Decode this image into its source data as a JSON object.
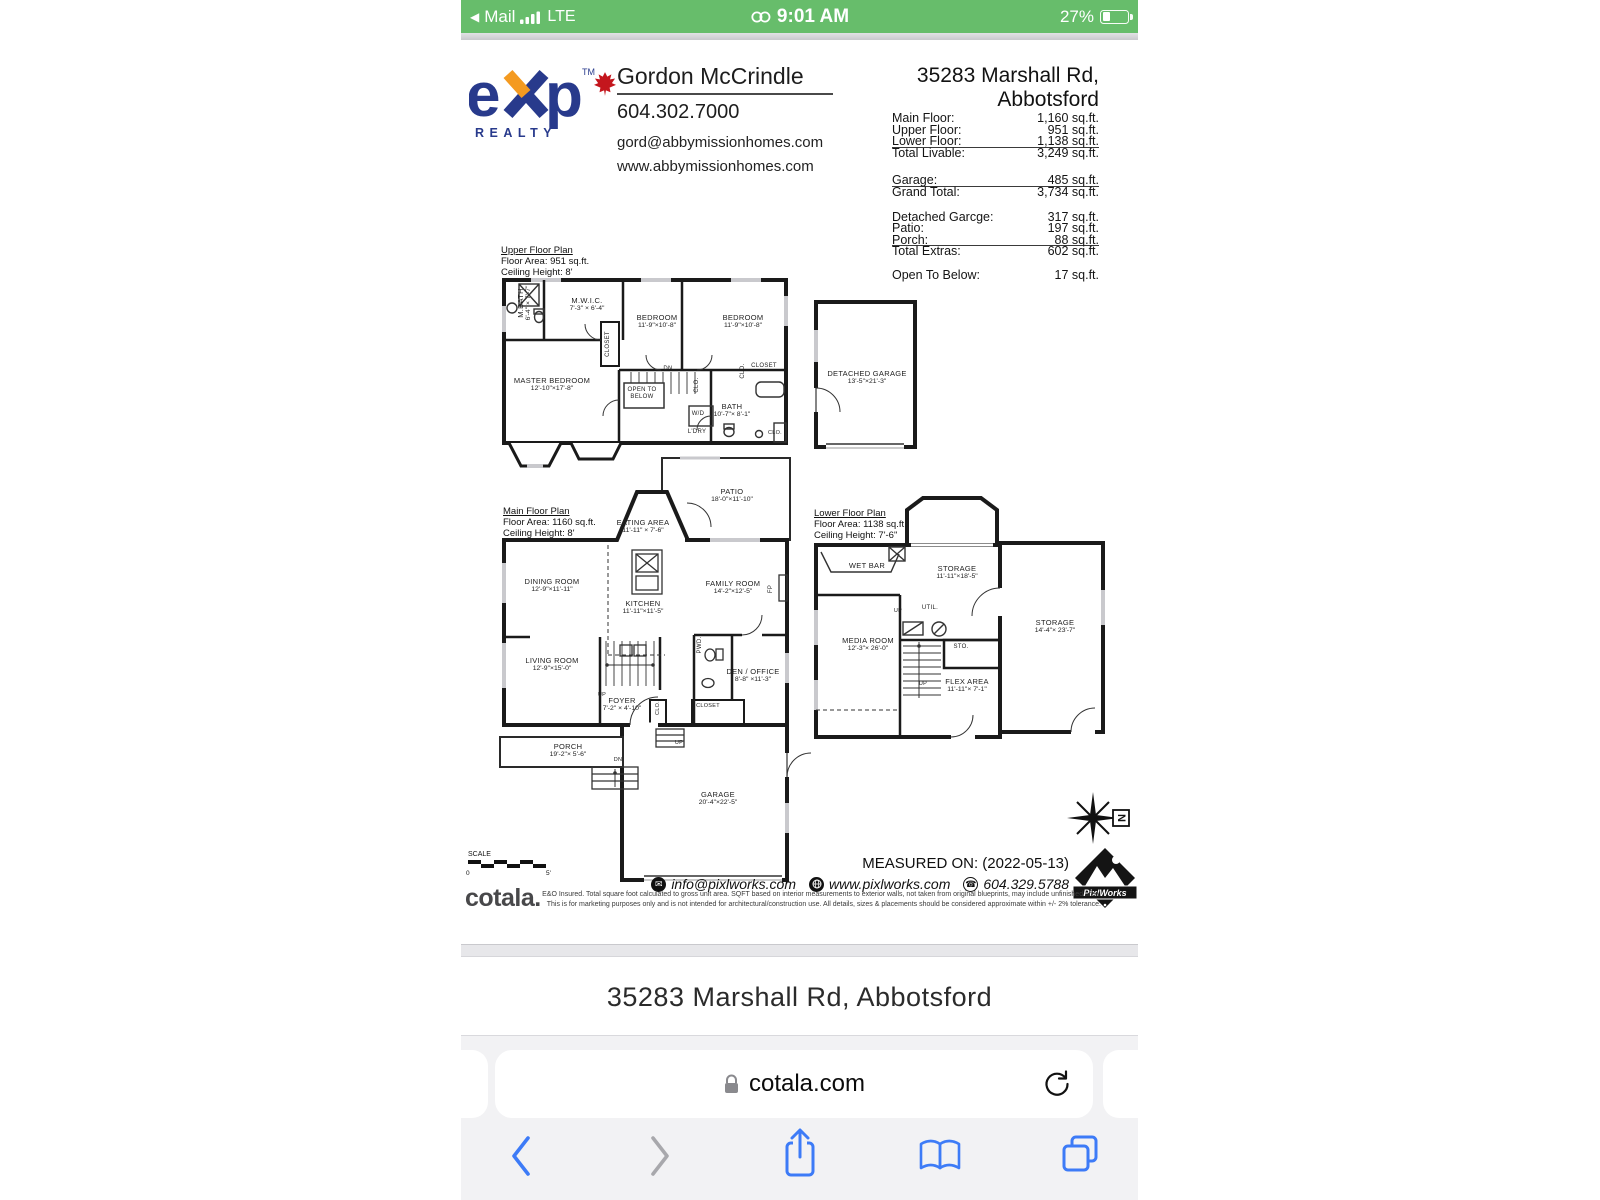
{
  "status_bar": {
    "back_app": "Mail",
    "network": "LTE",
    "time": "9:01 AM",
    "battery": "27%"
  },
  "sheet": {
    "brand": {
      "e": "e",
      "p": "p",
      "tm": "TM",
      "realty": "REALTY",
      "colors": {
        "navy": "#283a8c",
        "orange": "#f49a20",
        "leaf_red": "#c4161d"
      }
    },
    "agent": {
      "name": "Gordon McCrindle",
      "phone": "604.302.7000",
      "email": "gord@abbymissionhomes.com",
      "website": "www.abbymissionhomes.com"
    },
    "address": {
      "line1": "35283 Marshall Rd,",
      "line2": "Abbotsford"
    },
    "area_table": {
      "groups": [
        {
          "rows": [
            {
              "label": "Main Floor:",
              "value": "1,160 sq.ft."
            },
            {
              "label": "Upper Floor:",
              "value": "951 sq.ft."
            },
            {
              "label": "Lower Floor:",
              "value": "1,138 sq.ft."
            },
            {
              "label": "Total Livable:",
              "value": "3,249 sq.ft."
            }
          ]
        },
        {
          "rows": [
            {
              "label": "Garage:",
              "value": "485 sq.ft."
            },
            {
              "label": "Grand Total:",
              "value": "3,734 sq.ft."
            }
          ]
        },
        {
          "rows": [
            {
              "label": "Detached Garcge:",
              "value": "317 sq.ft."
            },
            {
              "label": "Patio:",
              "value": "197 sq.ft."
            },
            {
              "label": "Porch:",
              "value": "88 sq.ft."
            },
            {
              "label": "Total Extras:",
              "value": "602 sq.ft."
            }
          ]
        },
        {
          "rows": [
            {
              "label": "Open To Below:",
              "value": "17 sq.ft."
            }
          ]
        }
      ]
    },
    "plans": {
      "upper": {
        "title": "Upper Floor Plan",
        "area": "Floor Area: 951 sq.ft.",
        "ceiling": "Ceiling Height: 8'",
        "rooms": [
          {
            "name": "M.BATH",
            "dims": "6'-4\" × 7'-7\""
          },
          {
            "name": "M.W.I.C.",
            "dims": "7'-3\" × 6'-4\""
          },
          {
            "name": "BEDROOM",
            "dims": "11'-9\"×10'-8\""
          },
          {
            "name": "BEDROOM",
            "dims": "11'-9\"×10'-8\""
          },
          {
            "name": "MASTER BEDROOM",
            "dims": "12'-10\"×17'-8\""
          },
          {
            "name": "OPEN TO BELOW",
            "dims": ""
          },
          {
            "name": "CLOSET",
            "dims": ""
          },
          {
            "name": "DN",
            "dims": ""
          },
          {
            "name": "CLO.",
            "dims": ""
          },
          {
            "name": "CLO.",
            "dims": ""
          },
          {
            "name": "CLOSET",
            "dims": ""
          },
          {
            "name": "W/D",
            "dims": ""
          },
          {
            "name": "L'DRY",
            "dims": ""
          },
          {
            "name": "BATH",
            "dims": "10'-7\"× 8'-1\""
          },
          {
            "name": "CLO.",
            "dims": ""
          }
        ]
      },
      "main": {
        "title": "Main Floor Plan",
        "area": "Floor Area: 1160 sq.ft.",
        "ceiling": "Ceiling Height: 8'",
        "rooms": [
          {
            "name": "PATIO",
            "dims": "18'-0\"×11'-10\""
          },
          {
            "name": "EATING AREA",
            "dims": "11'-11\" × 7'-6\""
          },
          {
            "name": "DINING ROOM",
            "dims": "12'-9\"×11'-11\""
          },
          {
            "name": "KITCHEN",
            "dims": "11'-11\"×11'-5\""
          },
          {
            "name": "FAMILY ROOM",
            "dims": "14'-2\"×12'-5\""
          },
          {
            "name": "FP",
            "dims": ""
          },
          {
            "name": "LIVING ROOM",
            "dims": "12'-9\"×15'-0\""
          },
          {
            "name": "FOYER",
            "dims": "7'-2\" × 4'-10\""
          },
          {
            "name": "DEN / OFFICE",
            "dims": "8'-8\" ×11'-3\""
          },
          {
            "name": "PWD.",
            "dims": ""
          },
          {
            "name": "CLOSET",
            "dims": ""
          },
          {
            "name": "CLO.",
            "dims": ""
          },
          {
            "name": "PORCH",
            "dims": "19'-2\"× 5'-6\""
          },
          {
            "name": "GARAGE",
            "dims": "20'-4\"×22'-5\""
          },
          {
            "name": "UP",
            "dims": ""
          },
          {
            "name": "DN",
            "dims": ""
          },
          {
            "name": "UP",
            "dims": ""
          }
        ]
      },
      "lower": {
        "title": "Lower Floor Plan",
        "area": "Floor Area: 1138 sq.ft.",
        "ceiling": "Ceiling Height: 7'-6\"",
        "rooms": [
          {
            "name": "WET BAR",
            "dims": ""
          },
          {
            "name": "STORAGE",
            "dims": "11'-11\"×18'-5\""
          },
          {
            "name": "MEDIA ROOM",
            "dims": "12'-3\"× 26'-0\""
          },
          {
            "name": "UTIL.",
            "dims": ""
          },
          {
            "name": "STO.",
            "dims": ""
          },
          {
            "name": "FLEX AREA",
            "dims": "11'-11\"× 7'-1\""
          },
          {
            "name": "STORAGE",
            "dims": "14'-4\"× 23'-7\""
          },
          {
            "name": "UP",
            "dims": ""
          },
          {
            "name": "UP",
            "dims": ""
          }
        ]
      },
      "detached": {
        "name": "DETACHED GARAGE",
        "dims": "13'-5\"×21'-3\""
      }
    },
    "compass": {
      "n": "N"
    },
    "scale": {
      "label": "SCALE",
      "start": "0",
      "end": "5'"
    },
    "footer": {
      "measured_on": "MEASURED ON: (2022-05-13)",
      "email": "info@pixlworks.com",
      "website": "www.pixlworks.com",
      "phone": "604.329.5788",
      "vendor": "PixlWorks",
      "cotala": "cotala.",
      "disclaimer1": "E&O Insured.  Total square foot calculated to gross unit area. SQFT based on interior measurements to exterior walls, not taken from original blueprints, may include unfinished area.",
      "disclaimer2": "This is for marketing purposes only and is not intended for architectural/construction use.  All details, sizes & placements should be considered approximate within +/- 2%  tolerance."
    }
  },
  "caption": "35283 Marshall Rd, Abbotsford",
  "browser": {
    "url_host": "cotala.com"
  },
  "icons": {
    "back_to_app": "left-triangle",
    "signal": "signal-bars",
    "hotspot": "linked-rings",
    "battery": "battery-27-percent",
    "lock": "padlock",
    "reload": "circular-arrow",
    "back": "chevron-left",
    "forward": "chevron-right",
    "share": "square-with-up-arrow",
    "bookmarks": "open-book",
    "tabs": "stacked-squares",
    "compass": "eight-point-star-north",
    "scale_bar": "stepped-scale-bar",
    "envelope": "envelope-circle",
    "globe": "globe-circle",
    "telephone": "phone-circle",
    "vendor_logo": "mountain-diamond-badge",
    "maple_leaf": "maple-leaf"
  }
}
